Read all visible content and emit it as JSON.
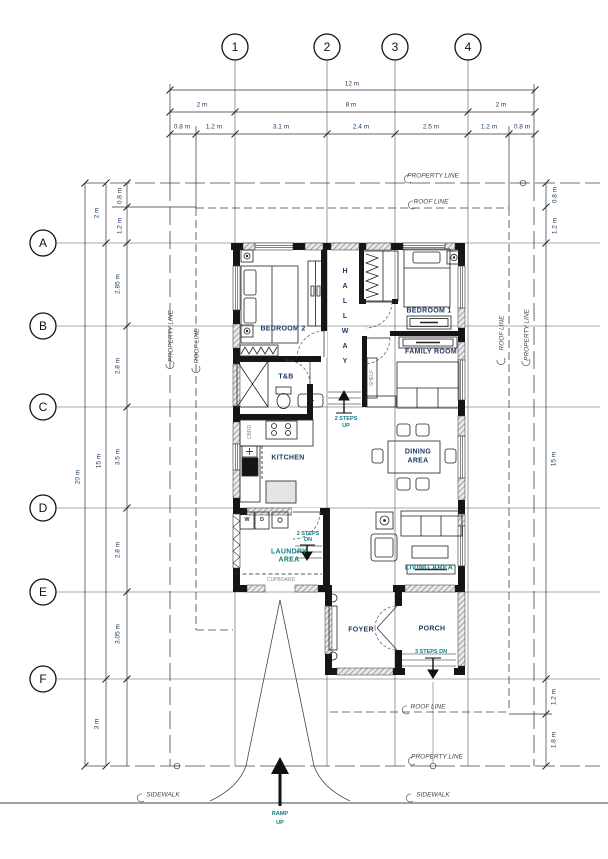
{
  "grid": {
    "columns": [
      "1",
      "2",
      "3",
      "4"
    ],
    "rows": [
      "A",
      "B",
      "C",
      "D",
      "E",
      "F"
    ]
  },
  "dimensions": {
    "top": {
      "total": "12 m",
      "groups": [
        "2 m",
        "8 m",
        "2 m"
      ],
      "segments": [
        "0.8 m",
        "1.2 m",
        "3.1 m",
        "2.4 m",
        "2.5 m",
        "1.2 m",
        "0.8 m"
      ]
    },
    "left": {
      "overall": "20 m",
      "house": "15 m",
      "frontage": "2 m",
      "split_top": [
        "0.8 m",
        "1.2 m"
      ],
      "rows": [
        "2.85 m",
        "2.8 m",
        "3.5 m",
        "2.8 m",
        "3.05 m"
      ],
      "rear": "3 m"
    },
    "right": {
      "split_top": [
        "0.8 m",
        "1.2 m"
      ],
      "house": "15 m",
      "bottom": [
        "1.2 m",
        "1.8 m"
      ]
    }
  },
  "site": {
    "property_line": "PROPERTY LINE",
    "roof_line": "ROOF LINE",
    "sidewalk": "SIDEWALK"
  },
  "rooms": {
    "bedroom2": "BEDROOM 2",
    "bedroom1": "BEDROOM 1",
    "hallway": "HALLWAY",
    "family": "FAMILY ROOM",
    "toilet_bath": "T&B",
    "kitchen": "KITCHEN",
    "dining_1": "DINING",
    "dining_2": "AREA",
    "laundry_1": "LAUNDRY",
    "laundry_2": "AREA",
    "living": "LIVING AREA",
    "foyer": "FOYER",
    "porch": "PORCH"
  },
  "annotations": {
    "steps_up_1": "2 STEPS",
    "steps_up_2": "UP",
    "steps_dn_1": "2 STEPS",
    "steps_dn_2": "DN",
    "steps3": "3 STEPS DN",
    "cupboard": "CUPBOARD",
    "shelf": "SHELF",
    "cbrd": "CBRD",
    "ramp_1": "RAMP",
    "ramp_2": "UP",
    "washer": "W",
    "dryer": "D"
  },
  "colors": {
    "wall": "#151515",
    "dim_text": "#1c3a5e",
    "room_text": "#1f3864",
    "annotation_teal": "#0e7c80",
    "hatch": "#777777"
  }
}
